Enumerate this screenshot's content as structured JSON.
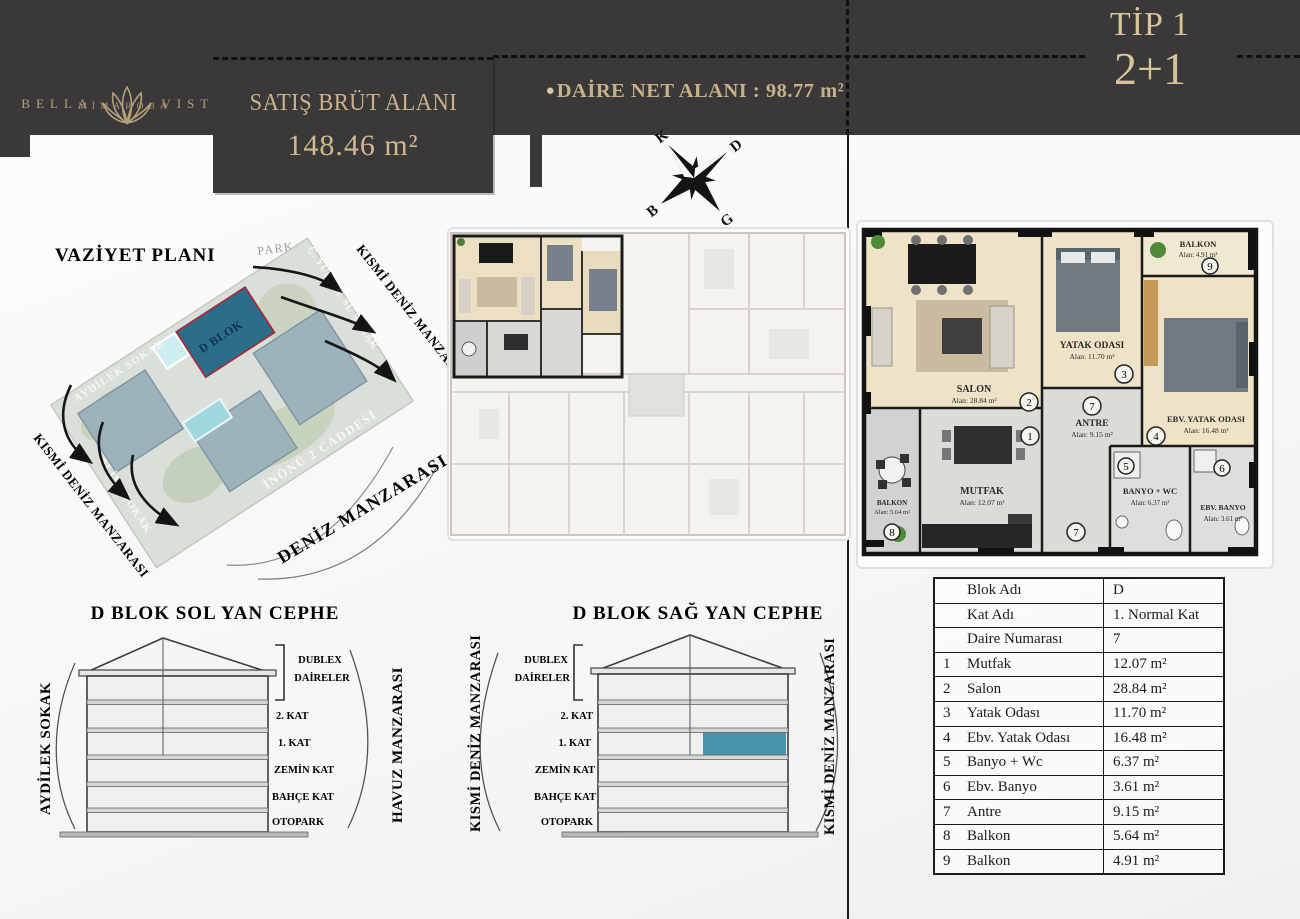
{
  "header": {
    "brand_left": "BELLA",
    "brand_right": "VISTA",
    "brand_sub": "MİMAROBA",
    "gross_label": "SATIŞ BRÜT ALANI",
    "gross_value": "148.46 m²",
    "net_bullet": "●",
    "net_label": "DAİRE NET ALANI : 98.77 m²",
    "type_line1": "TİP 1",
    "type_line2": "2+1"
  },
  "compass": {
    "n": "K",
    "e": "D",
    "s": "G",
    "w": "B"
  },
  "site": {
    "title": "VAZİYET PLANI",
    "park": "PARK",
    "block": "D BLOK",
    "street_top": "AYDİLEK SOKAK",
    "street_right": "Ç. YÜKSEL SÜ SOKAK",
    "street_left": "ALİYE SOKAK",
    "street_bottom": "İNÖNÜ 2 CADDESİ",
    "view_top_right": "KISMİ DENİZ MANZARASI",
    "view_bottom_left": "KISMİ DENİZ MANZARASI",
    "view_bottom_right": "DENİZ MANZARASI"
  },
  "plan": {
    "rooms": {
      "mutfak": {
        "num": "1",
        "name": "MUTFAK",
        "area": "Alan: 12.07 m²"
      },
      "salon": {
        "num": "2",
        "name": "SALON",
        "area": "Alan: 28.84 m²"
      },
      "yatak": {
        "num": "3",
        "name": "YATAK ODASI",
        "area": "Alan: 11.70 m²"
      },
      "ebv_yatak": {
        "num": "4",
        "name": "EBV. YATAK ODASI",
        "area": "Alan: 16.48 m²"
      },
      "banyo_wc": {
        "num": "5",
        "name": "BANYO + WC",
        "area": "Alan: 6.37 m²"
      },
      "ebv_banyo": {
        "num": "6",
        "name": "EBV. BANYO",
        "area": "Alan: 3.61 m²"
      },
      "antre": {
        "num": "7",
        "name": "ANTRE",
        "area": "Alan: 9.15 m²"
      },
      "balkon_8": {
        "num": "8",
        "name": "BALKON",
        "area": "Alan: 5.64 m²"
      },
      "balkon_9": {
        "num": "9",
        "name": "BALKON",
        "area": "Alan: 4.91 m²"
      }
    }
  },
  "elevations": {
    "left_title": "D BLOK SOL YAN CEPHE",
    "right_title": "D BLOK SAĞ YAN CEPHE",
    "dublex_line1": "DUBLEX",
    "dublex_line2": "DAİRELER",
    "floors": [
      "2. KAT",
      "1. KAT",
      "ZEMİN KAT",
      "BAHÇE KAT",
      "OTOPARK"
    ],
    "left_side_left_label": "AYDİLEK SOKAK",
    "left_side_right_label": "HAVUZ MANZARASI",
    "right_side_left_label": "KISMİ DENİZ MANZARASI",
    "right_side_right_label": "KISMİ DENİZ MANZARASI"
  },
  "table": {
    "rows": [
      {
        "no": "",
        "label": "Blok Adı",
        "value": "D"
      },
      {
        "no": "",
        "label": "Kat Adı",
        "value": "1. Normal Kat"
      },
      {
        "no": "",
        "label": "Daire Numarası",
        "value": "7"
      },
      {
        "no": "1",
        "label": "Mutfak",
        "value": "12.07 m²"
      },
      {
        "no": "2",
        "label": "Salon",
        "value": "28.84 m²"
      },
      {
        "no": "3",
        "label": "Yatak Odası",
        "value": "11.70 m²"
      },
      {
        "no": "4",
        "label": "Ebv. Yatak Odası",
        "value": "16.48 m²"
      },
      {
        "no": "5",
        "label": "Banyo + Wc",
        "value": "6.37 m²"
      },
      {
        "no": "6",
        "label": "Ebv. Banyo",
        "value": "3.61 m²"
      },
      {
        "no": "7",
        "label": "Antre",
        "value": "9.15 m²"
      },
      {
        "no": "8",
        "label": "Balkon",
        "value": "5.64 m²"
      },
      {
        "no": "9",
        "label": "Balkon",
        "value": "4.91 m²"
      }
    ]
  },
  "colors": {
    "band": "#3a3839",
    "gold": "#c9b289",
    "highlight_blue": "#4a93ae",
    "d_blok_teal": "#2d6d8c"
  }
}
